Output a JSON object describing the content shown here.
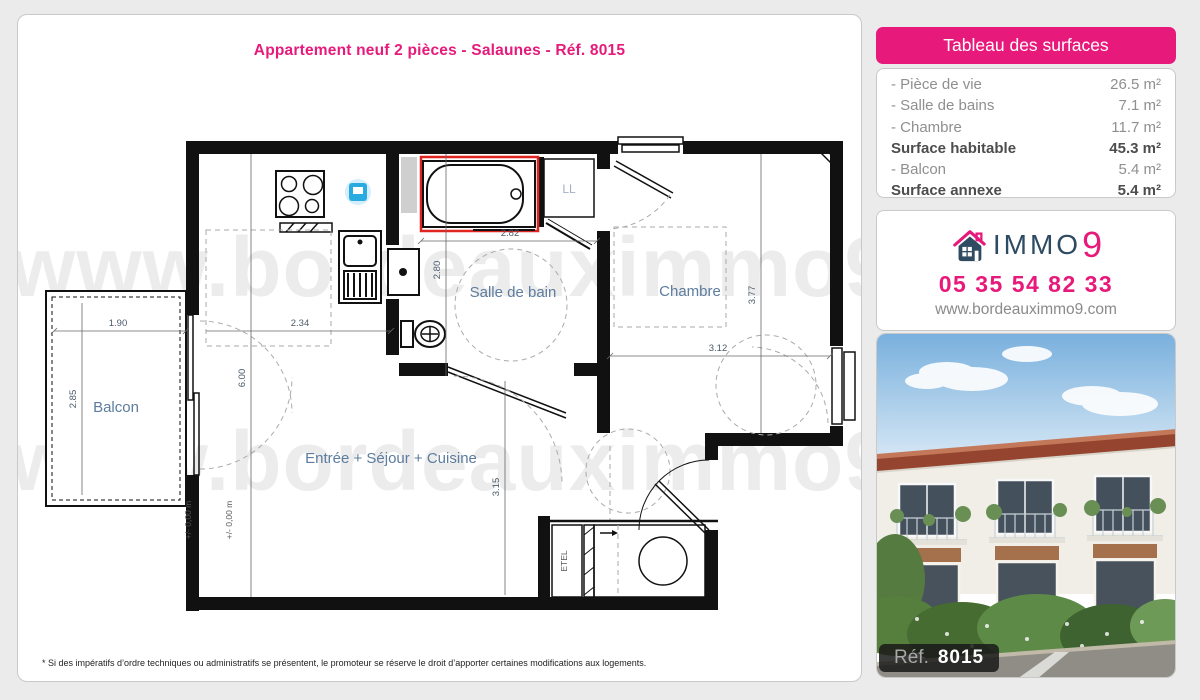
{
  "colors": {
    "background": "#ebebeb",
    "accent_pink": "#e7197b",
    "navy": "#2f4b62",
    "wall_black": "#111111",
    "bath_red": "#e02520",
    "appliance_blue": "#29abe2",
    "room_label_blue": "#5d7c9e"
  },
  "title": "Appartement neuf 2 pièces - Salaunes - Réf. 8015",
  "watermark": "www.bordeauximmo9.com",
  "surfaces": {
    "header": "Tableau des surfaces",
    "rows": [
      {
        "label": "- Pièce de vie",
        "value": "26.5 m²"
      },
      {
        "label": "- Salle de bains",
        "value": "7.1 m²"
      },
      {
        "label": "- Chambre",
        "value": "11.7 m²"
      },
      {
        "label": "Surface habitable",
        "value": "45.3 m²"
      },
      {
        "label": "- Balcon",
        "value": "5.4 m²"
      },
      {
        "label": "Surface annexe",
        "value": "5.4 m²"
      }
    ]
  },
  "agency": {
    "brand_text": "IMMO",
    "brand_digit": "9",
    "phone": "05 35 54 82 33",
    "website": "www.bordeauximmo9.com"
  },
  "photo": {
    "ref_label": "Réf.",
    "ref_number": "8015"
  },
  "floorplan": {
    "rooms": {
      "living": "Entrée + Séjour + Cuisine",
      "bathroom": "Salle de bain",
      "bedroom": "Chambre",
      "balcony": "Balcon",
      "laundry_closet": "LL",
      "electrical_closet": "ETEL"
    },
    "level_marker": "+/- 0,00 m",
    "dims": {
      "balcony_width": "1.90",
      "balcony_depth": "2.85",
      "kitchen_width": "2.34",
      "living_length": "6.00",
      "bathroom_width": "2.82",
      "bathroom_depth": "2.80",
      "bedroom_width": "3.12",
      "bedroom_depth": "3.77",
      "living_depth": "3.15"
    }
  },
  "footer_note": "* Si des impératifs d’ordre techniques ou administratifs se présentent, le promoteur se réserve le droit d’apporter certaines modifications aux logements."
}
